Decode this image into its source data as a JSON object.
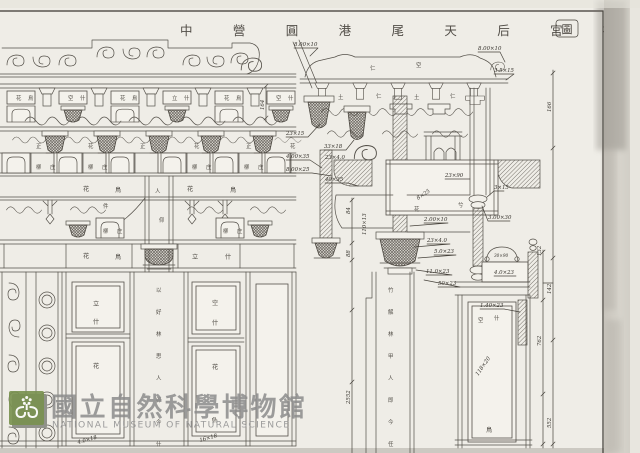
{
  "document": {
    "type": "scanned architectural design drawing",
    "institution_watermark": true
  },
  "title": {
    "text": "中 營 圓 港 尾 天 后 宮 神 房 設 計",
    "seal": "圖"
  },
  "watermark": {
    "cjk": "國立自然科學博物館",
    "en": "NATIONAL MUSEUM OF NATURAL SCIENCE"
  },
  "colors": {
    "paper": "#efede7",
    "ink": "#47433c",
    "logo_green": "#7a9150",
    "watermark_gray": "#8c8c8c"
  },
  "callouts": [
    "8.00×10",
    "8.00×10",
    "3.5×15",
    "23×15",
    "33×18",
    "4.00×35",
    "23×4.0",
    "8.00×25",
    "40×35",
    "23×90",
    "8×25",
    "3×15",
    "2.00×10",
    "23×4.0",
    "5.0×23",
    "11.0×23",
    "50×23",
    "30×90",
    "4.0×23",
    "1.40×23",
    "118×20",
    "4.0×18",
    "16×18",
    "3.00×30",
    "110×13"
  ],
  "dims": [
    "166",
    "142",
    "552",
    "132",
    "762",
    "88",
    "84",
    "2552",
    "164"
  ],
  "parts": {
    "rowA": [
      "花",
      "鳥",
      "空",
      "什",
      "花",
      "鳥",
      "立",
      "什",
      "花",
      "鳥",
      "空",
      "什"
    ],
    "rowB": [
      "正",
      "花",
      "正",
      "花",
      "正",
      "花"
    ],
    "rowC": [
      "柳",
      "庄",
      "柳",
      "庄",
      "柳",
      "庄",
      "柳",
      "庄"
    ],
    "beam1": [
      "花",
      "鳥",
      "花",
      "鳥"
    ],
    "rowD": [
      "柳",
      "庄",
      "柳",
      "庄"
    ],
    "beam2": [
      "花",
      "鳥",
      "立",
      "什"
    ],
    "colcap": [
      "人",
      "仰"
    ],
    "doors": [
      "立",
      "什",
      "花",
      "空",
      "什",
      "花",
      "鳥"
    ],
    "section_top": [
      "仁",
      "空",
      "土",
      "仁",
      "土",
      "仁"
    ],
    "section_mid": [
      "件",
      "花",
      "兮"
    ],
    "section_door": [
      "空",
      "什",
      "鳥"
    ],
    "col_left": [
      "以",
      "好",
      "林",
      "思",
      "人",
      "卯",
      "今",
      "什"
    ],
    "col_right": [
      "竹",
      "解",
      "林",
      "甲",
      "人",
      "即",
      "今",
      "任"
    ]
  }
}
